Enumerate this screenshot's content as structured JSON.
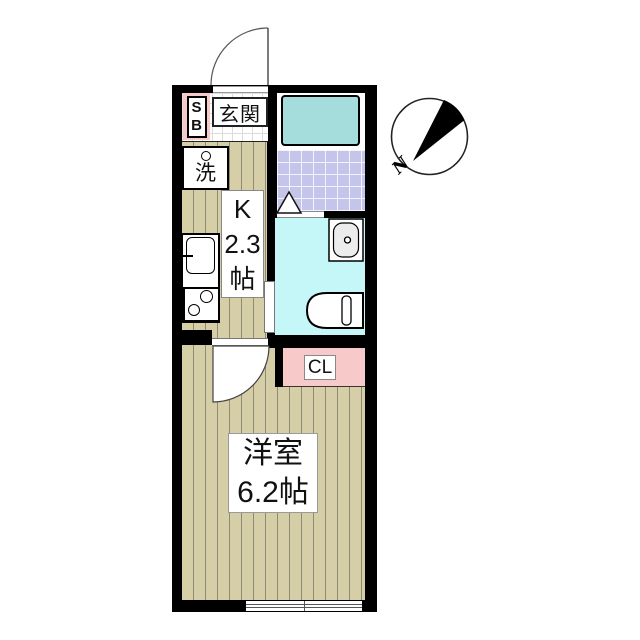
{
  "plan": {
    "type": "apartment-floor-plan",
    "compass": {
      "north_label": "N"
    },
    "rooms": {
      "entrance": {
        "label": "玄関"
      },
      "shoe_box": {
        "lines": [
          "S",
          "B"
        ]
      },
      "washer": {
        "label": "洗"
      },
      "kitchen": {
        "lines": [
          "K",
          "2.3",
          "帖"
        ],
        "name": "K",
        "size_tatami": "2.3帖"
      },
      "bathroom": {},
      "toilet": {},
      "closet": {
        "label": "CL"
      },
      "western_room": {
        "lines": [
          "洋室",
          "6.2帖"
        ],
        "name": "洋室",
        "size_tatami": "6.2帖"
      }
    },
    "colors": {
      "wall": "#000000",
      "wood_floor": "#d6cea6",
      "wood_stripe": "#8f8c75",
      "bath_tile": "#c5c5ec",
      "bathtub": "#a5dcdc",
      "toilet_room": "#c5f6f8",
      "pink_storage": "#f8c9c9",
      "label_bg": "#ffffff",
      "text": "#111111"
    }
  }
}
